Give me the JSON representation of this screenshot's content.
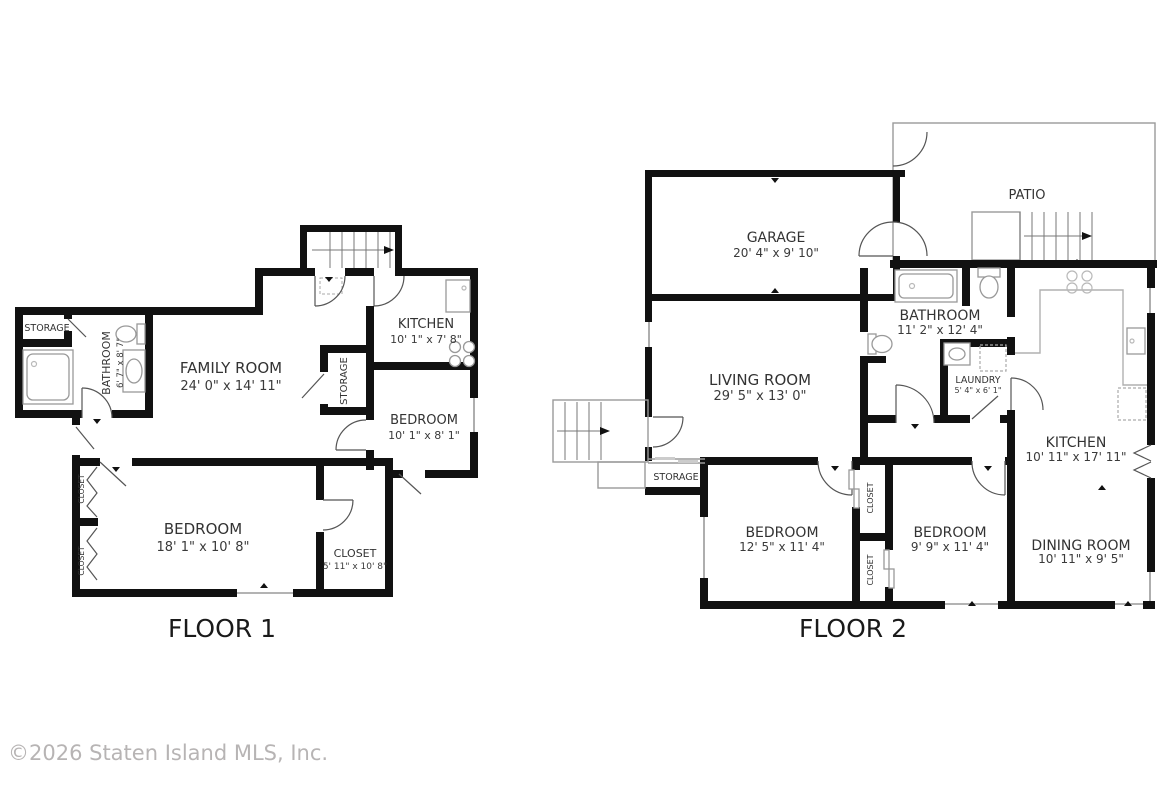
{
  "copyright": "©2026 Staten Island MLS, Inc.",
  "floor1": {
    "title": "FLOOR 1",
    "rooms": {
      "storage_left": {
        "name": "STORAGE"
      },
      "bathroom": {
        "name": "BATHROOM",
        "dims": "6' 7\" x 8' 7\""
      },
      "family_room": {
        "name": "FAMILY ROOM",
        "dims": "24' 0\" x 14' 11\""
      },
      "kitchen": {
        "name": "KITCHEN",
        "dims": "10' 1\" x 7' 8\""
      },
      "storage_center": {
        "name": "STORAGE"
      },
      "bedroom_small": {
        "name": "BEDROOM",
        "dims": "10' 1\" x 8' 1\""
      },
      "bedroom_large": {
        "name": "BEDROOM",
        "dims": "18' 1\" x 10' 8\""
      },
      "closet_main": {
        "name": "CLOSET",
        "dims": "5' 11\" x 10' 8\""
      },
      "closet_a": {
        "name": "CLOSET"
      },
      "closet_b": {
        "name": "CLOSET"
      }
    }
  },
  "floor2": {
    "title": "FLOOR 2",
    "rooms": {
      "garage": {
        "name": "GARAGE",
        "dims": "20' 4\" x 9' 10\""
      },
      "patio": {
        "name": "PATIO"
      },
      "living_room": {
        "name": "LIVING ROOM",
        "dims": "29' 5\" x 13' 0\""
      },
      "bathroom": {
        "name": "BATHROOM",
        "dims": "11' 2\" x 12' 4\""
      },
      "laundry": {
        "name": "LAUNDRY",
        "dims": "5' 4\" x 6' 1\""
      },
      "kitchen": {
        "name": "KITCHEN",
        "dims": "10' 11\" x 17' 11\""
      },
      "dining_room": {
        "name": "DINING ROOM",
        "dims": "10' 11\" x 9' 5\""
      },
      "storage": {
        "name": "STORAGE"
      },
      "bedroom_left": {
        "name": "BEDROOM",
        "dims": "12' 5\" x 11' 4\""
      },
      "bedroom_right": {
        "name": "BEDROOM",
        "dims": "9' 9\" x 11' 4\""
      },
      "closet_a": {
        "name": "CLOSET"
      },
      "closet_b": {
        "name": "CLOSET"
      }
    }
  }
}
